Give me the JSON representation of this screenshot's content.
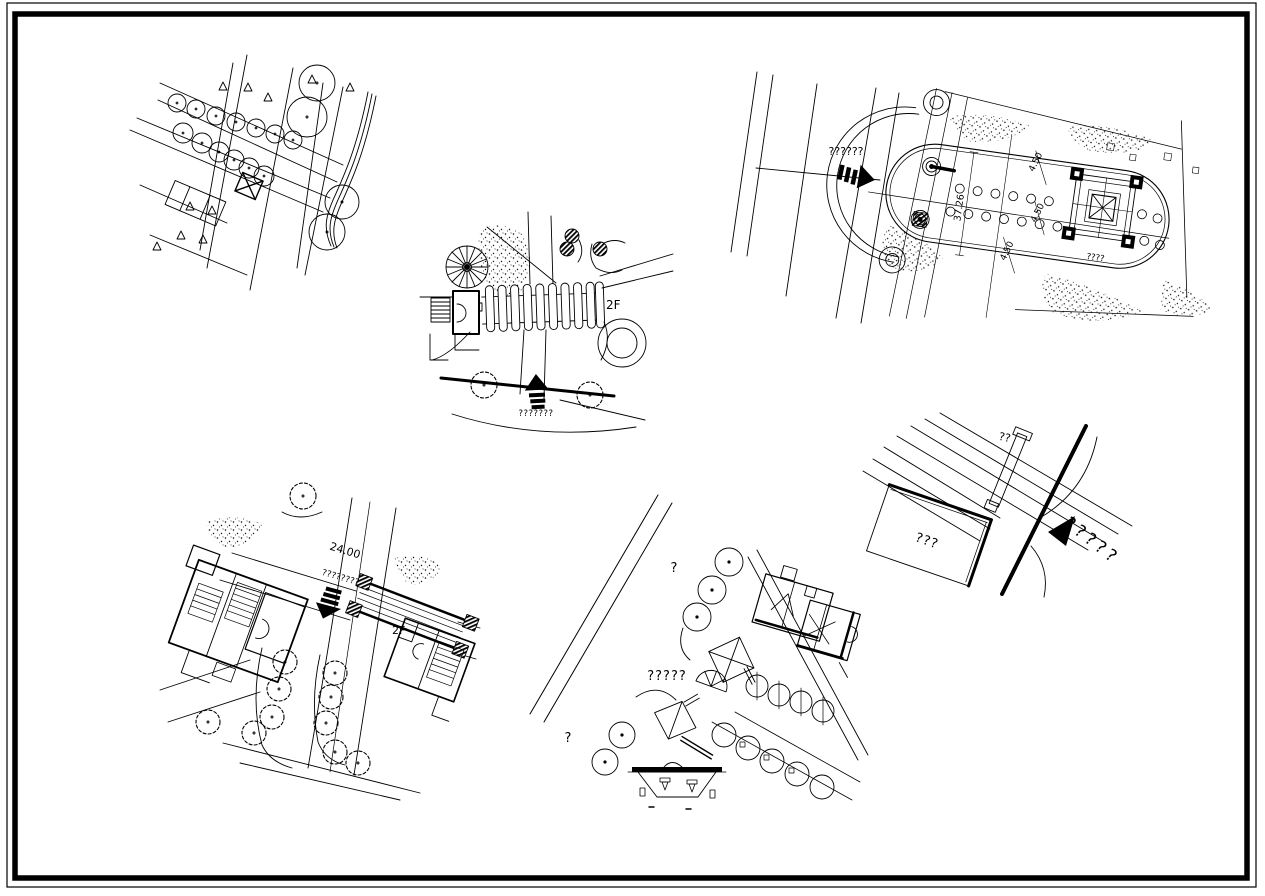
{
  "sheet": {
    "background": "#ffffff",
    "ink": "#000000",
    "frame_style": "double black border, thick inner line"
  },
  "plans": {
    "top_left": {
      "name": "road junction planting plan",
      "text_labels": []
    },
    "top_middle": {
      "name": "entrance pergola plan",
      "floor_label": "2F",
      "entrance_caption": "???????"
    },
    "top_right": {
      "name": "boulevard gateway plan",
      "road_caption": "??????",
      "pavilion_caption": "????",
      "dim_length": "37.26",
      "dim_top": "4.50",
      "dim_mid": "4.50",
      "dim_bottom": "4.50"
    },
    "middle_right": {
      "name": "site access plan",
      "building_caption": "???",
      "marker_caption": "??",
      "road_caption": "?????"
    },
    "bottom_left": {
      "name": "road crossing bridge plan",
      "dim_road_width": "24.00",
      "caption": "????????",
      "floor_label": "2F"
    },
    "bottom_middle": {
      "name": "garden path plan",
      "caption": "?????",
      "query_mark_1": "?",
      "query_mark_2": "?"
    }
  }
}
